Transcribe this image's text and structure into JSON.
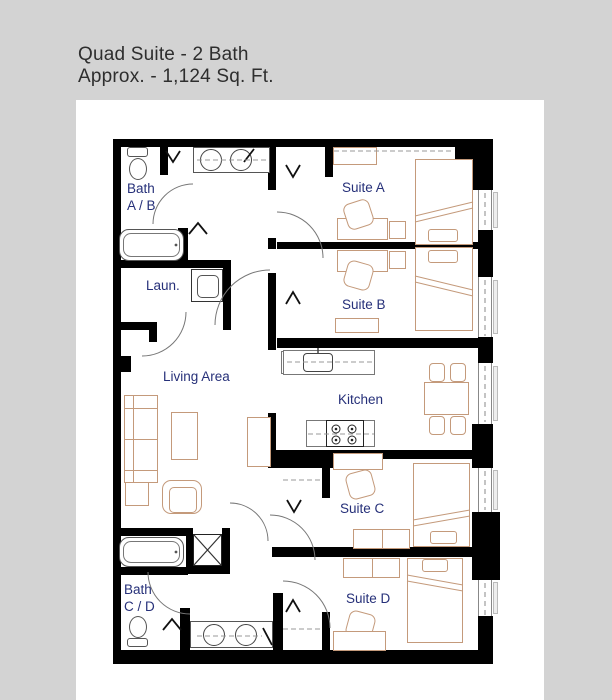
{
  "title": {
    "line1": "Quad Suite - 2 Bath",
    "line2": "Approx. - 1,124 Sq. Ft."
  },
  "rooms": {
    "bath_ab": {
      "line1": "Bath",
      "line2": "A / B"
    },
    "laundry": {
      "label": "Laun."
    },
    "suite_a": {
      "label": "Suite A"
    },
    "suite_b": {
      "label": "Suite B"
    },
    "living": {
      "label": "Living Area"
    },
    "kitchen": {
      "label": "Kitchen"
    },
    "suite_c": {
      "label": "Suite C"
    },
    "bath_cd": {
      "line1": "Bath",
      "line2": "C / D"
    },
    "suite_d": {
      "label": "Suite D"
    }
  },
  "colors": {
    "background": "#d3d3d3",
    "panel": "#ffffff",
    "wall": "#000000",
    "room_label": "#263079",
    "furniture_line": "#c49a7b",
    "fixture_line": "#555555",
    "title_text": "#2e2e2e"
  }
}
